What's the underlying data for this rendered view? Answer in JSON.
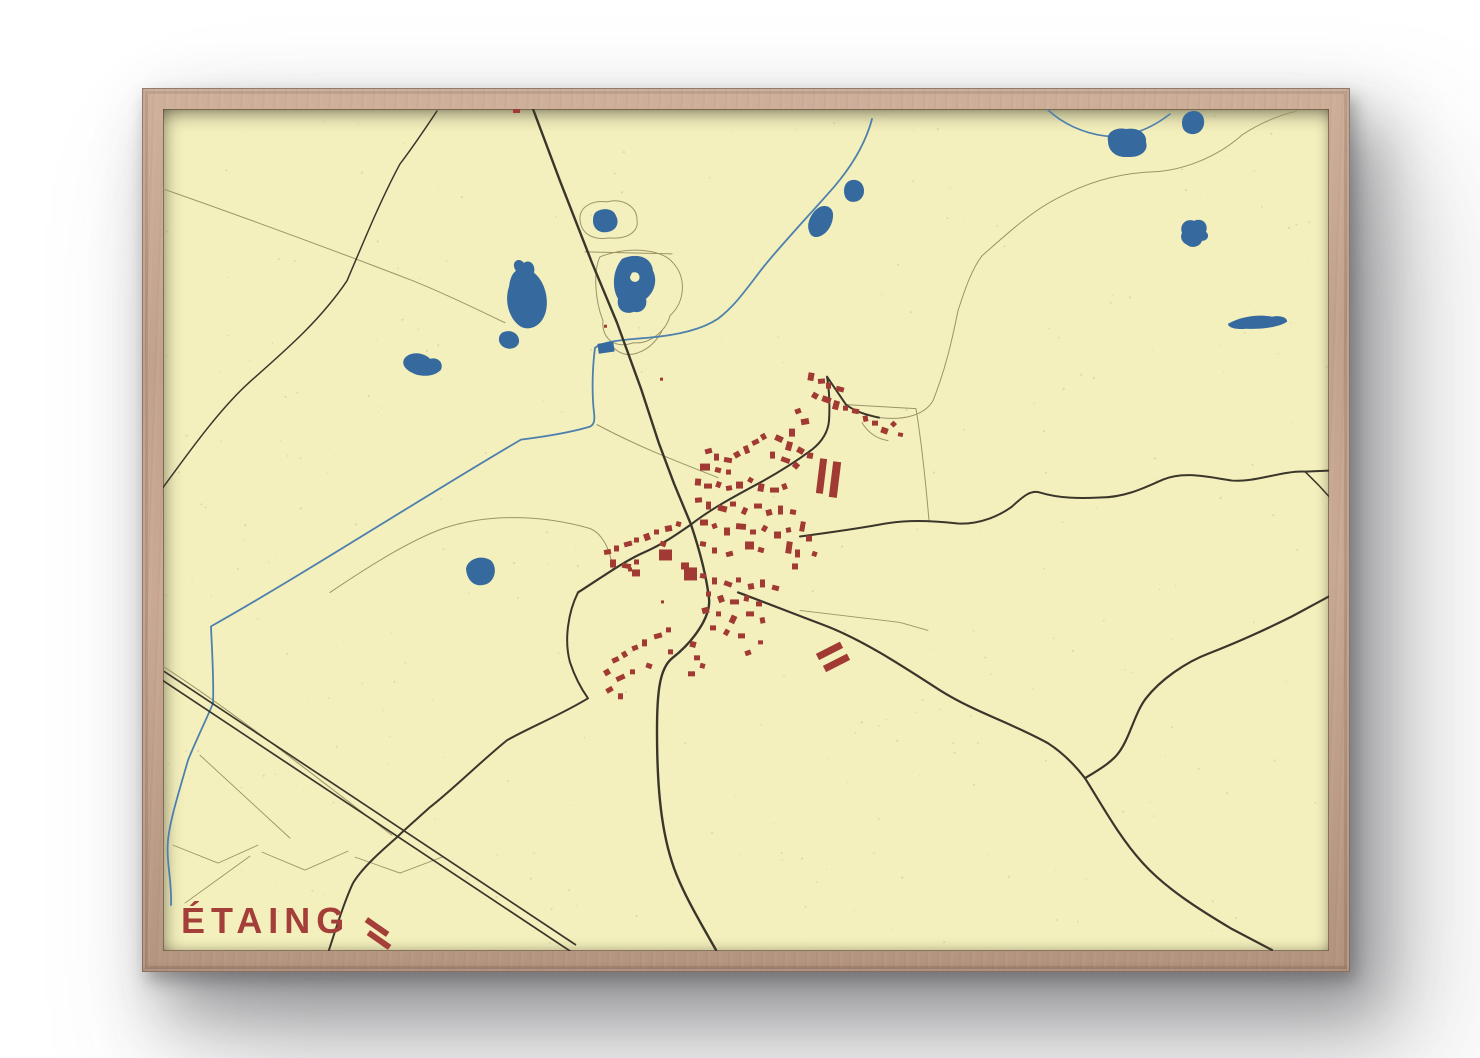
{
  "poster": {
    "title": "ÉTAING",
    "title_color": "#a33f38",
    "paper_color": "#f4f0bd",
    "frame_color": "#c2a28c",
    "water_color": "#366a9e",
    "stream_color": "#4d80ad",
    "building_color": "#a03a33",
    "road_main_color": "#3a362b",
    "road_medium_color": "#4a4538",
    "road_minor_color": "#9a9468",
    "speck_color": "#7a7248"
  },
  "map": {
    "title_pos": {
      "x": 181,
      "y": 933
    },
    "roads_main": [
      {
        "d": "M533,108 L560,180 L592,262 L617,322 L641,388 L659,443 L674,483 L691,524",
        "w": 2.4
      },
      {
        "d": "M691,524 C698,545 706,572 709,598 C711,615 695,640 672,658 C660,668 657,690 657,730 C657,780 660,825 672,862 C680,888 700,922 716,950",
        "w": 2.4
      },
      {
        "d": "M578,592 C600,578 625,560 646,551 C664,543 678,533 691,524",
        "w": 2.2
      },
      {
        "d": "M691,524 C710,509 734,496 762,481 C780,471 800,458 812,449 C822,441 828,432 829,420 C830,404 829,388 827,376 M827,376 C833,385 840,395 846,404 C855,411 866,414 879,417",
        "w": 2.0
      },
      {
        "d": "M800,536 C830,532 858,528 880,524 C905,519 930,520 958,523 C980,524 1000,515 1012,506 C1022,497 1030,489 1040,492 C1060,498 1080,498 1100,497 C1125,497 1145,487 1163,479 C1185,470 1210,477 1232,480 C1255,482 1282,470 1305,471 L1329,470",
        "w": 2.0
      },
      {
        "d": "M1305,471 L1318,484 L1329,496",
        "w": 1.5
      },
      {
        "d": "M738,592 C760,600 790,612 822,624 C860,638 900,664 940,690 C975,712 1010,722 1048,743 C1062,752 1075,765 1085,778",
        "w": 2.2
      },
      {
        "d": "M1085,778 C1098,770 1112,762 1119,752 C1130,737 1135,712 1146,698 C1160,680 1185,662 1209,653 C1240,641 1268,628 1292,616 L1329,596",
        "w": 2.2
      },
      {
        "d": "M1085,778 C1102,805 1120,838 1142,862 C1165,888 1200,910 1232,929 L1272,950",
        "w": 2.2
      },
      {
        "d": "M578,592 C568,612 564,640 570,662 C576,680 583,691 588,698 C560,715 530,727 507,740 C480,762 452,790 430,807 C418,818 406,828 396,838 C380,852 362,868 353,883 C345,900 337,925 329,950",
        "w": 2.0
      },
      {
        "d": "M437,110 C425,128 410,150 400,163 C380,200 362,245 347,280 C320,320 285,350 250,381 C220,408 190,450 163,487",
        "w": 1.5
      }
    ],
    "railway": [
      {
        "d": "M164,671 L576,945",
        "w": 1.7
      },
      {
        "d": "M161,679 L573,953",
        "w": 1.7
      }
    ],
    "roads_minor": [
      {
        "d": "M163,188 C240,215 330,248 413,280 C450,295 480,310 505,322",
        "w": 1
      },
      {
        "d": "M846,404 L916,408 C922,445 926,485 929,520",
        "w": 1
      },
      {
        "d": "M880,417 C905,420 925,414 933,400 C945,370 952,340 958,310 C965,288 972,268 982,255 C1008,232 1032,210 1058,197 C1090,180 1122,172 1152,171 C1180,170 1215,158 1242,134 C1260,122 1280,114 1297,110",
        "w": 1
      },
      {
        "d": "M585,251 L672,253",
        "w": 1
      },
      {
        "d": "M330,592 C370,565 410,540 443,528 C490,512 545,515 590,528 C600,532 610,545 613,570",
        "w": 1
      },
      {
        "d": "M597,424 C640,447 680,462 718,477",
        "w": 1
      },
      {
        "d": "M173,845 L218,863 L258,845",
        "w": 0.9
      },
      {
        "d": "M262,852 L305,870 L348,851",
        "w": 0.9
      },
      {
        "d": "M355,857 L400,873 L442,857",
        "w": 0.9
      },
      {
        "d": "M200,755 L290,838",
        "w": 0.9
      },
      {
        "d": "M250,856 L185,903",
        "w": 0.9
      },
      {
        "d": "M163,666 C240,716 320,780 392,835",
        "w": 1
      },
      {
        "d": "M862,422 C868,432 876,438 888,440",
        "w": 1
      },
      {
        "d": "M800,610 L900,622 L928,630",
        "w": 0.9
      }
    ],
    "pond_outlines": [
      {
        "d": "M580,219 C579,206 592,199 607,201 C622,197 637,205 637,219 C639,231 627,239 609,237 C592,240 581,232 580,219 Z",
        "w": 1
      },
      {
        "d": "M600,256 C628,245 662,248 673,262 C686,276 686,300 670,315 C666,330 650,344 633,342 C615,349 601,337 603,320 C595,300 593,270 600,256 Z",
        "w": 1
      },
      {
        "d": "M612,345 C618,353 628,356 638,352 C650,348 658,338 662,330",
        "w": 1
      }
    ],
    "streams": [
      {
        "d": "M872,118 C864,148 846,172 834,186 C815,208 780,245 762,268 C745,290 735,305 718,318 C700,330 672,335 648,337 C625,339 605,340 595,347 C592,370 592,395 594,412 C595,420 594,424 590,426 C570,432 545,436 521,439 C430,492 310,570 211,626 C212,652 214,680 213,703 C206,720 196,740 188,760 C178,795 170,820 168,840 C166,862 172,880 171,905",
        "w": 1.8
      },
      {
        "d": "M1048,109 C1062,122 1082,132 1105,135 C1130,137 1152,127 1170,113",
        "w": 1.6
      }
    ],
    "lakes": [
      "M516,270 C510,262 518,255 524,262 C530,258 536,264 534,272 C544,280 549,296 546,310 C543,324 531,331 521,326 C509,319 504,300 509,286 C510,278 512,273 516,270 Z",
      "M502,332 C510,328 518,332 519,339 C520,346 512,350 505,347 C498,344 497,336 502,332 Z",
      "M405,357 C412,350 424,352 430,358 C438,356 444,362 441,369 C435,376 420,377 412,372 C404,368 401,362 405,357 Z",
      "M466,568 C468,558 482,554 491,560 C497,566 496,578 488,583 C478,588 467,583 466,568 Z",
      "M596,211 C604,206 614,208 616,215 C620,222 616,230 608,231 C600,233 593,228 593,220 C593,215 594,213 596,211 Z",
      "M622,258 C638,251 652,257 653,270 C658,280 654,292 646,298 C648,306 642,313 634,311 C624,315 616,308 618,298 C612,288 612,270 622,258 Z M632,272 C637,270 641,274 639,279 C636,283 630,281 630,276 Z",
      "M844,190 C844,183 848,179 854,179 C860,179 864,184 864,190 C864,197 859,201 853,201 C847,201 844,196 844,190 Z",
      "M809,230 C806,222 812,210 820,206 C828,203 834,208 833,216 C832,226 826,234 818,236 C813,237 810,234 809,230 Z",
      "M1182,122 C1182,115 1187,110 1194,110 C1201,110 1205,116 1204,123 C1203,130 1197,134 1191,133 C1185,132 1182,128 1182,122 Z",
      "M1108,140 C1106,131 1116,126 1126,128 C1138,126 1147,132 1146,141 C1149,150 1140,157 1128,156 C1116,157 1108,150 1108,140 Z",
      "M1182,232 C1179,224 1186,217 1194,220 C1202,216 1209,223 1206,231 C1210,234 1208,240 1202,240 C1200,246 1192,248 1187,244 C1181,241 1180,236 1182,232 Z",
      "M1228,323 C1240,316 1258,313 1272,316 C1280,314 1288,317 1287,321 C1280,326 1262,329 1246,328 C1236,329 1228,327 1228,323 Z"
    ],
    "water_rects": [
      [
        598,
        342,
        16,
        10,
        -8
      ]
    ],
    "buildings": [
      [
        808,
        372,
        6,
        8,
        10
      ],
      [
        818,
        378,
        7,
        5,
        -5
      ],
      [
        826,
        382,
        5,
        6,
        0
      ],
      [
        836,
        386,
        8,
        5,
        15
      ],
      [
        812,
        392,
        6,
        6,
        30
      ],
      [
        822,
        396,
        9,
        6,
        20
      ],
      [
        833,
        400,
        6,
        9,
        15
      ],
      [
        843,
        405,
        5,
        5,
        0
      ],
      [
        852,
        408,
        7,
        5,
        10
      ],
      [
        863,
        415,
        5,
        6,
        -10
      ],
      [
        872,
        420,
        6,
        5,
        0
      ],
      [
        881,
        427,
        7,
        6,
        20
      ],
      [
        891,
        421,
        5,
        5,
        45
      ],
      [
        898,
        432,
        5,
        4,
        10
      ],
      [
        795,
        408,
        6,
        5,
        -20
      ],
      [
        801,
        418,
        8,
        6,
        -10
      ],
      [
        789,
        428,
        6,
        8,
        0
      ],
      [
        775,
        435,
        8,
        6,
        25
      ],
      [
        786,
        441,
        6,
        9,
        15
      ],
      [
        797,
        447,
        7,
        6,
        30
      ],
      [
        807,
        452,
        6,
        6,
        10
      ],
      [
        770,
        451,
        5,
        7,
        0
      ],
      [
        781,
        457,
        9,
        5,
        20
      ],
      [
        793,
        462,
        6,
        6,
        40
      ],
      [
        705,
        448,
        7,
        5,
        -15
      ],
      [
        714,
        453,
        5,
        7,
        0
      ],
      [
        724,
        457,
        8,
        5,
        10
      ],
      [
        734,
        451,
        6,
        6,
        -30
      ],
      [
        744,
        445,
        5,
        8,
        -20
      ],
      [
        752,
        439,
        7,
        5,
        -25
      ],
      [
        761,
        433,
        5,
        6,
        -30
      ],
      [
        700,
        463,
        10,
        7,
        0
      ],
      [
        715,
        467,
        6,
        5,
        15
      ],
      [
        726,
        469,
        5,
        5,
        0
      ],
      [
        695,
        478,
        6,
        7,
        5
      ],
      [
        704,
        483,
        8,
        5,
        0
      ],
      [
        716,
        481,
        5,
        6,
        20
      ],
      [
        726,
        485,
        6,
        5,
        -10
      ],
      [
        736,
        481,
        7,
        7,
        0
      ],
      [
        748,
        477,
        5,
        5,
        30
      ],
      [
        758,
        483,
        6,
        8,
        10
      ],
      [
        770,
        487,
        9,
        5,
        0
      ],
      [
        782,
        483,
        5,
        6,
        -20
      ],
      [
        695,
        497,
        7,
        5,
        -5
      ],
      [
        706,
        501,
        5,
        8,
        0
      ],
      [
        718,
        505,
        9,
        6,
        15
      ],
      [
        730,
        501,
        6,
        5,
        0
      ],
      [
        742,
        507,
        5,
        7,
        25
      ],
      [
        754,
        503,
        8,
        5,
        0
      ],
      [
        766,
        509,
        6,
        6,
        -15
      ],
      [
        778,
        505,
        5,
        9,
        0
      ],
      [
        790,
        509,
        6,
        5,
        10
      ],
      [
        700,
        519,
        8,
        6,
        0
      ],
      [
        712,
        523,
        5,
        5,
        -20
      ],
      [
        724,
        527,
        6,
        8,
        0
      ],
      [
        736,
        523,
        10,
        6,
        5
      ],
      [
        750,
        529,
        6,
        5,
        0
      ],
      [
        762,
        525,
        5,
        6,
        30
      ],
      [
        774,
        531,
        7,
        7,
        0
      ],
      [
        786,
        527,
        5,
        5,
        -10
      ],
      [
        745,
        541,
        9,
        8,
        0
      ],
      [
        758,
        547,
        6,
        5,
        15
      ],
      [
        700,
        541,
        6,
        5,
        10
      ],
      [
        712,
        547,
        5,
        6,
        0
      ],
      [
        726,
        551,
        7,
        5,
        -15
      ],
      [
        604,
        549,
        7,
        5,
        -10
      ],
      [
        614,
        545,
        5,
        6,
        0
      ],
      [
        624,
        541,
        8,
        5,
        -15
      ],
      [
        634,
        537,
        5,
        5,
        0
      ],
      [
        644,
        533,
        6,
        7,
        -20
      ],
      [
        654,
        529,
        5,
        5,
        0
      ],
      [
        665,
        525,
        7,
        6,
        -10
      ],
      [
        676,
        521,
        5,
        5,
        15
      ],
      [
        610,
        559,
        6,
        8,
        0
      ],
      [
        622,
        563,
        9,
        5,
        10
      ],
      [
        634,
        559,
        5,
        5,
        0
      ],
      [
        660,
        541,
        6,
        5,
        20
      ],
      [
        659,
        549,
        13,
        11,
        0
      ],
      [
        681,
        562,
        8,
        7,
        0
      ],
      [
        632,
        569,
        8,
        7,
        0
      ],
      [
        684,
        567,
        13,
        13,
        0
      ],
      [
        700,
        573,
        6,
        5,
        10
      ],
      [
        712,
        577,
        5,
        7,
        0
      ],
      [
        724,
        581,
        8,
        5,
        20
      ],
      [
        736,
        577,
        5,
        5,
        0
      ],
      [
        748,
        583,
        6,
        6,
        -10
      ],
      [
        760,
        579,
        5,
        8,
        0
      ],
      [
        772,
        585,
        7,
        5,
        15
      ],
      [
        706,
        591,
        5,
        5,
        0
      ],
      [
        718,
        595,
        6,
        7,
        -20
      ],
      [
        730,
        599,
        9,
        5,
        0
      ],
      [
        744,
        595,
        5,
        6,
        10
      ],
      [
        756,
        601,
        6,
        5,
        0
      ],
      [
        702,
        607,
        7,
        6,
        -15
      ],
      [
        716,
        611,
        5,
        5,
        0
      ],
      [
        730,
        615,
        6,
        8,
        25
      ],
      [
        746,
        611,
        8,
        5,
        0
      ],
      [
        760,
        617,
        5,
        6,
        -10
      ],
      [
        710,
        625,
        6,
        5,
        0
      ],
      [
        724,
        629,
        5,
        6,
        30
      ],
      [
        738,
        633,
        7,
        5,
        0
      ],
      [
        612,
        657,
        7,
        5,
        -25
      ],
      [
        622,
        651,
        5,
        6,
        -30
      ],
      [
        632,
        645,
        6,
        5,
        -20
      ],
      [
        642,
        639,
        5,
        7,
        0
      ],
      [
        654,
        633,
        8,
        5,
        -15
      ],
      [
        666,
        627,
        5,
        5,
        0
      ],
      [
        604,
        669,
        6,
        6,
        -30
      ],
      [
        616,
        675,
        9,
        5,
        -25
      ],
      [
        630,
        669,
        5,
        5,
        0
      ],
      [
        606,
        687,
        7,
        5,
        -30
      ],
      [
        618,
        693,
        5,
        6,
        0
      ],
      [
        646,
        663,
        6,
        5,
        20
      ],
      [
        668,
        649,
        5,
        5,
        0
      ],
      [
        690,
        641,
        6,
        6,
        15
      ],
      [
        786,
        541,
        6,
        12,
        8
      ],
      [
        795,
        549,
        5,
        8,
        0
      ],
      [
        792,
        563,
        6,
        6,
        0
      ],
      [
        800,
        521,
        5,
        10,
        10
      ],
      [
        806,
        535,
        6,
        6,
        0
      ],
      [
        812,
        551,
        5,
        5,
        20
      ],
      [
        694,
        655,
        6,
        5,
        0
      ],
      [
        700,
        663,
        5,
        5,
        15
      ],
      [
        688,
        671,
        7,
        5,
        0
      ],
      [
        628,
        567,
        4,
        4,
        0
      ],
      [
        661,
        600,
        3,
        3,
        0
      ],
      [
        745,
        650,
        6,
        5,
        -20
      ],
      [
        758,
        640,
        5,
        4,
        0
      ]
    ],
    "big_bars": [
      [
        818,
        458,
        7,
        35,
        7
      ],
      [
        831,
        461,
        8,
        36,
        7
      ],
      [
        816,
        647,
        27,
        7,
        -27
      ],
      [
        823,
        659,
        27,
        7,
        -27
      ]
    ],
    "red_marks": [
      [
        513,
        107,
        7,
        5,
        0
      ],
      [
        604,
        324,
        3,
        3,
        0
      ],
      [
        660,
        377,
        3,
        3,
        0
      ]
    ],
    "title_dashes": [
      [
        364,
        924,
        26,
        6,
        35
      ],
      [
        366,
        937,
        26,
        6,
        35
      ]
    ]
  }
}
